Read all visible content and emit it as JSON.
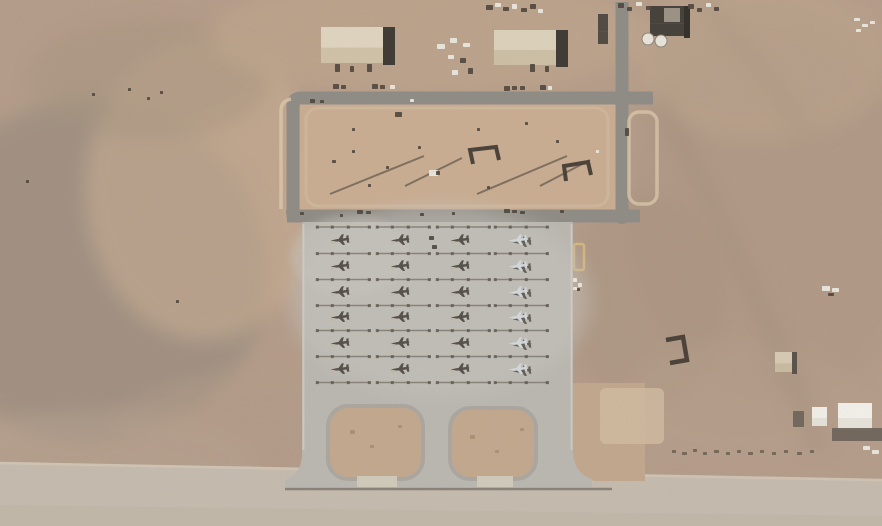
{
  "scene": {
    "kind": "satellite-aerial-view-of-airbase",
    "width": 882,
    "height": 526,
    "aircraft_visible_count": 24
  },
  "colors": {
    "desert_base": "#b49c89",
    "desert_light": "#c7ad93",
    "desert_dark": "#98897c",
    "dirt_enclosure": "#c9ad92",
    "island_dirt": "#c2a88d",
    "dirt_patch_light": "#cfbaa0",
    "apron": "#bab7b1",
    "apron_light": "#c7c4be",
    "road": "#8f8b85",
    "pavement_bottom": "#c4bbae",
    "pavement_edge_light": "#dad3c5",
    "pavement_edge_dark": "#7b756c",
    "berm_pale": "#d9c6aa",
    "berm_yellow": "#d8b97c",
    "roof_light": "#ded4bf",
    "roof_mid": "#cfc2a8",
    "shadow_building": "#3f3a34",
    "dark_structure": "#46403a",
    "tank_white": "#e8e4da",
    "jet_dark": "#56504a",
    "jet_light": "#d3d8dc",
    "jet_shadow": "#4e483f",
    "jet_glint": "#c3b59c",
    "tiedown_line": "#837d74",
    "tiedown_blob": "#5f594f",
    "spot_dark": "#4f473e",
    "spot_white": "#eceae3",
    "spot_scrub": "#6f6455",
    "spot_shadow": "#6b6358",
    "spot_dirtmark": "#a98f74",
    "island_ring": "#a7a39c",
    "ramp_stub": "#d0cabb",
    "track": "#a18d7b",
    "revetment": "#4a4238"
  },
  "aircraft": {
    "rows_y": [
      240,
      266,
      292,
      317,
      343,
      369
    ],
    "columns": [
      {
        "x": 340,
        "type": "dark"
      },
      {
        "x": 400,
        "type": "dark"
      },
      {
        "x": 460,
        "type": "dark"
      },
      {
        "x": 518,
        "type": "light"
      }
    ],
    "jet_scale": 0.78,
    "jet_rotate_deg": -7,
    "tiedown_y": [
      227,
      253.5,
      279.5,
      305.5,
      330.5,
      356.5,
      382.5
    ],
    "tiedown_dx1": -23,
    "tiedown_dx2": 31
  },
  "buildings": [
    {
      "x": 321,
      "y": 27,
      "w": 62,
      "h": 36,
      "roof": "#ded4bf",
      "roof2": "#cfc2a8",
      "sw": 12,
      "shadow": "#3f3a34"
    },
    {
      "x": 494,
      "y": 30,
      "w": 62,
      "h": 35,
      "roof": "#dbd1bb",
      "roof2": "#ccbfa5",
      "sw": 12,
      "shadow": "#3f3a34"
    },
    {
      "x": 650,
      "y": 6,
      "w": 34,
      "h": 30,
      "roof": "#46403a",
      "roof2": "#46403a",
      "sw": 6,
      "shadow": "#332f2a",
      "inner": {
        "x": 664,
        "y": 8,
        "w": 16,
        "h": 14,
        "c": "#9b9185"
      }
    },
    {
      "x": 598,
      "y": 14,
      "w": 10,
      "h": 30,
      "roof": "#504a42",
      "roof2": "#504a42",
      "sw": 0,
      "shadow": "#504a42"
    },
    {
      "x": 812,
      "y": 407,
      "w": 15,
      "h": 19,
      "roof": "#f0eee8",
      "roof2": "#e4e1d8",
      "sw": 0,
      "shadow": "#f0eee8"
    },
    {
      "x": 838,
      "y": 403,
      "w": 34,
      "h": 27,
      "roof": "#f2f0ea",
      "roof2": "#e6e3da",
      "sw": 0,
      "shadow": "#f2f0ea"
    },
    {
      "x": 775,
      "y": 352,
      "w": 17,
      "h": 20,
      "roof": "#d6cab4",
      "roof2": "#c9bba2",
      "sw": 5,
      "shadow": "#5a5248"
    }
  ],
  "tanks": [
    {
      "cx": 648,
      "cy": 39,
      "r": 6
    },
    {
      "cx": 661,
      "cy": 41,
      "r": 6
    }
  ],
  "spots": [
    [
      333,
      84,
      6,
      5,
      "spot_dark"
    ],
    [
      341,
      85,
      5,
      4,
      "spot_dark"
    ],
    [
      372,
      84,
      6,
      5,
      "spot_dark"
    ],
    [
      380,
      85,
      5,
      4,
      "spot_dark"
    ],
    [
      390,
      85,
      5,
      4,
      "spot_white"
    ],
    [
      335,
      64,
      5,
      8,
      "spot_dark"
    ],
    [
      350,
      66,
      4,
      6,
      "spot_dark"
    ],
    [
      367,
      64,
      5,
      8,
      "spot_dark"
    ],
    [
      504,
      86,
      6,
      5,
      "spot_dark"
    ],
    [
      512,
      86,
      5,
      4,
      "spot_dark"
    ],
    [
      520,
      86,
      5,
      4,
      "spot_dark"
    ],
    [
      540,
      85,
      6,
      5,
      "spot_dark"
    ],
    [
      548,
      86,
      4,
      4,
      "spot_white"
    ],
    [
      530,
      64,
      5,
      8,
      "spot_dark"
    ],
    [
      545,
      66,
      4,
      6,
      "spot_dark"
    ],
    [
      437,
      44,
      8,
      5,
      "spot_white"
    ],
    [
      450,
      38,
      7,
      5,
      "spot_white"
    ],
    [
      463,
      43,
      7,
      4,
      "spot_white"
    ],
    [
      448,
      55,
      6,
      4,
      "spot_white"
    ],
    [
      460,
      58,
      6,
      5,
      "spot_dark"
    ],
    [
      468,
      68,
      5,
      6,
      "spot_dark"
    ],
    [
      452,
      70,
      6,
      5,
      "spot_white"
    ],
    [
      486,
      5,
      7,
      5,
      "spot_dark"
    ],
    [
      495,
      3,
      6,
      4,
      "spot_white"
    ],
    [
      503,
      7,
      6,
      4,
      "spot_dark"
    ],
    [
      512,
      4,
      5,
      5,
      "spot_white"
    ],
    [
      521,
      8,
      6,
      4,
      "spot_dark"
    ],
    [
      530,
      4,
      6,
      5,
      "spot_dark"
    ],
    [
      538,
      9,
      5,
      4,
      "spot_white"
    ],
    [
      618,
      3,
      6,
      5,
      "spot_dark"
    ],
    [
      627,
      7,
      5,
      4,
      "spot_dark"
    ],
    [
      636,
      2,
      6,
      4,
      "spot_white"
    ],
    [
      646,
      6,
      5,
      4,
      "spot_dark"
    ],
    [
      688,
      4,
      6,
      5,
      "spot_dark"
    ],
    [
      697,
      8,
      5,
      4,
      "spot_dark"
    ],
    [
      706,
      3,
      5,
      4,
      "spot_white"
    ],
    [
      714,
      7,
      5,
      4,
      "spot_dark"
    ],
    [
      854,
      18,
      6,
      3,
      "spot_white"
    ],
    [
      862,
      24,
      6,
      3,
      "spot_white"
    ],
    [
      856,
      29,
      5,
      3,
      "spot_white"
    ],
    [
      870,
      21,
      5,
      3,
      "spot_white"
    ],
    [
      625,
      128,
      4,
      8,
      "spot_dark"
    ],
    [
      573,
      278,
      4,
      4,
      "spot_white"
    ],
    [
      578,
      283,
      4,
      4,
      "spot_white"
    ],
    [
      573,
      287,
      4,
      3,
      "spot_white"
    ],
    [
      577,
      288,
      3,
      3,
      "spot_dark"
    ],
    [
      822,
      286,
      8,
      5,
      "spot_white"
    ],
    [
      832,
      288,
      7,
      4,
      "spot_white"
    ],
    [
      828,
      293,
      6,
      3,
      "spot_dark"
    ],
    [
      332,
      160,
      4,
      3,
      "spot_dark"
    ],
    [
      352,
      150,
      3,
      3,
      "spot_dark"
    ],
    [
      368,
      184,
      3,
      3,
      "spot_dark"
    ],
    [
      386,
      166,
      3,
      3,
      "spot_dark"
    ],
    [
      418,
      146,
      3,
      3,
      "spot_dark"
    ],
    [
      352,
      128,
      3,
      3,
      "spot_dark"
    ],
    [
      395,
      112,
      7,
      5,
      "spot_dark"
    ],
    [
      410,
      99,
      4,
      3,
      "spot_white"
    ],
    [
      310,
      99,
      5,
      4,
      "spot_dark"
    ],
    [
      320,
      100,
      4,
      3,
      "spot_dark"
    ],
    [
      477,
      128,
      3,
      3,
      "spot_dark"
    ],
    [
      525,
      122,
      3,
      3,
      "spot_dark"
    ],
    [
      556,
      140,
      3,
      3,
      "spot_dark"
    ],
    [
      596,
      150,
      3,
      3,
      "spot_white"
    ],
    [
      487,
      186,
      3,
      3,
      "spot_dark"
    ],
    [
      429,
      170,
      9,
      6,
      "spot_white"
    ],
    [
      436,
      171,
      4,
      4,
      "spot_dark"
    ],
    [
      357,
      210,
      6,
      4,
      "spot_dark"
    ],
    [
      366,
      211,
      5,
      3,
      "spot_dark"
    ],
    [
      420,
      213,
      4,
      3,
      "spot_dark"
    ],
    [
      504,
      209,
      6,
      4,
      "spot_dark"
    ],
    [
      512,
      210,
      5,
      3,
      "spot_dark"
    ],
    [
      520,
      211,
      5,
      3,
      "spot_dark"
    ],
    [
      560,
      210,
      4,
      3,
      "spot_dark"
    ],
    [
      300,
      212,
      4,
      3,
      "spot_dark"
    ],
    [
      340,
      214,
      3,
      3,
      "spot_dark"
    ],
    [
      452,
      212,
      3,
      3,
      "spot_dark"
    ],
    [
      429,
      236,
      5,
      4,
      "spot_dark"
    ],
    [
      432,
      245,
      5,
      4,
      "spot_dark"
    ],
    [
      672,
      450,
      4,
      3,
      "spot_scrub"
    ],
    [
      682,
      452,
      5,
      3,
      "spot_scrub"
    ],
    [
      693,
      449,
      4,
      3,
      "spot_scrub"
    ],
    [
      703,
      452,
      4,
      3,
      "spot_scrub"
    ],
    [
      714,
      450,
      5,
      3,
      "spot_scrub"
    ],
    [
      726,
      452,
      4,
      3,
      "spot_scrub"
    ],
    [
      737,
      450,
      4,
      3,
      "spot_scrub"
    ],
    [
      748,
      452,
      5,
      3,
      "spot_scrub"
    ],
    [
      760,
      450,
      4,
      3,
      "spot_scrub"
    ],
    [
      772,
      452,
      4,
      3,
      "spot_scrub"
    ],
    [
      784,
      450,
      4,
      3,
      "spot_scrub"
    ],
    [
      797,
      452,
      5,
      3,
      "spot_scrub"
    ],
    [
      810,
      450,
      4,
      3,
      "spot_scrub"
    ],
    [
      863,
      446,
      7,
      4,
      "spot_white"
    ],
    [
      872,
      450,
      7,
      4,
      "spot_white"
    ],
    [
      793,
      411,
      11,
      16,
      "spot_shadow"
    ],
    [
      832,
      428,
      52,
      13,
      "spot_shadow"
    ],
    [
      92,
      93,
      3,
      3,
      "spot_dark"
    ],
    [
      147,
      97,
      3,
      3,
      "spot_dark"
    ],
    [
      160,
      91,
      3,
      3,
      "spot_dark"
    ],
    [
      128,
      88,
      3,
      3,
      "spot_dark"
    ],
    [
      26,
      180,
      3,
      3,
      "spot_dark"
    ],
    [
      176,
      300,
      3,
      3,
      "spot_dark"
    ],
    [
      350,
      430,
      5,
      4,
      "spot_dirtmark"
    ],
    [
      370,
      445,
      4,
      3,
      "spot_dirtmark"
    ],
    [
      398,
      425,
      4,
      3,
      "spot_dirtmark"
    ],
    [
      470,
      435,
      5,
      4,
      "spot_dirtmark"
    ],
    [
      495,
      450,
      4,
      3,
      "spot_dirtmark"
    ],
    [
      520,
      428,
      4,
      3,
      "spot_dirtmark"
    ]
  ]
}
